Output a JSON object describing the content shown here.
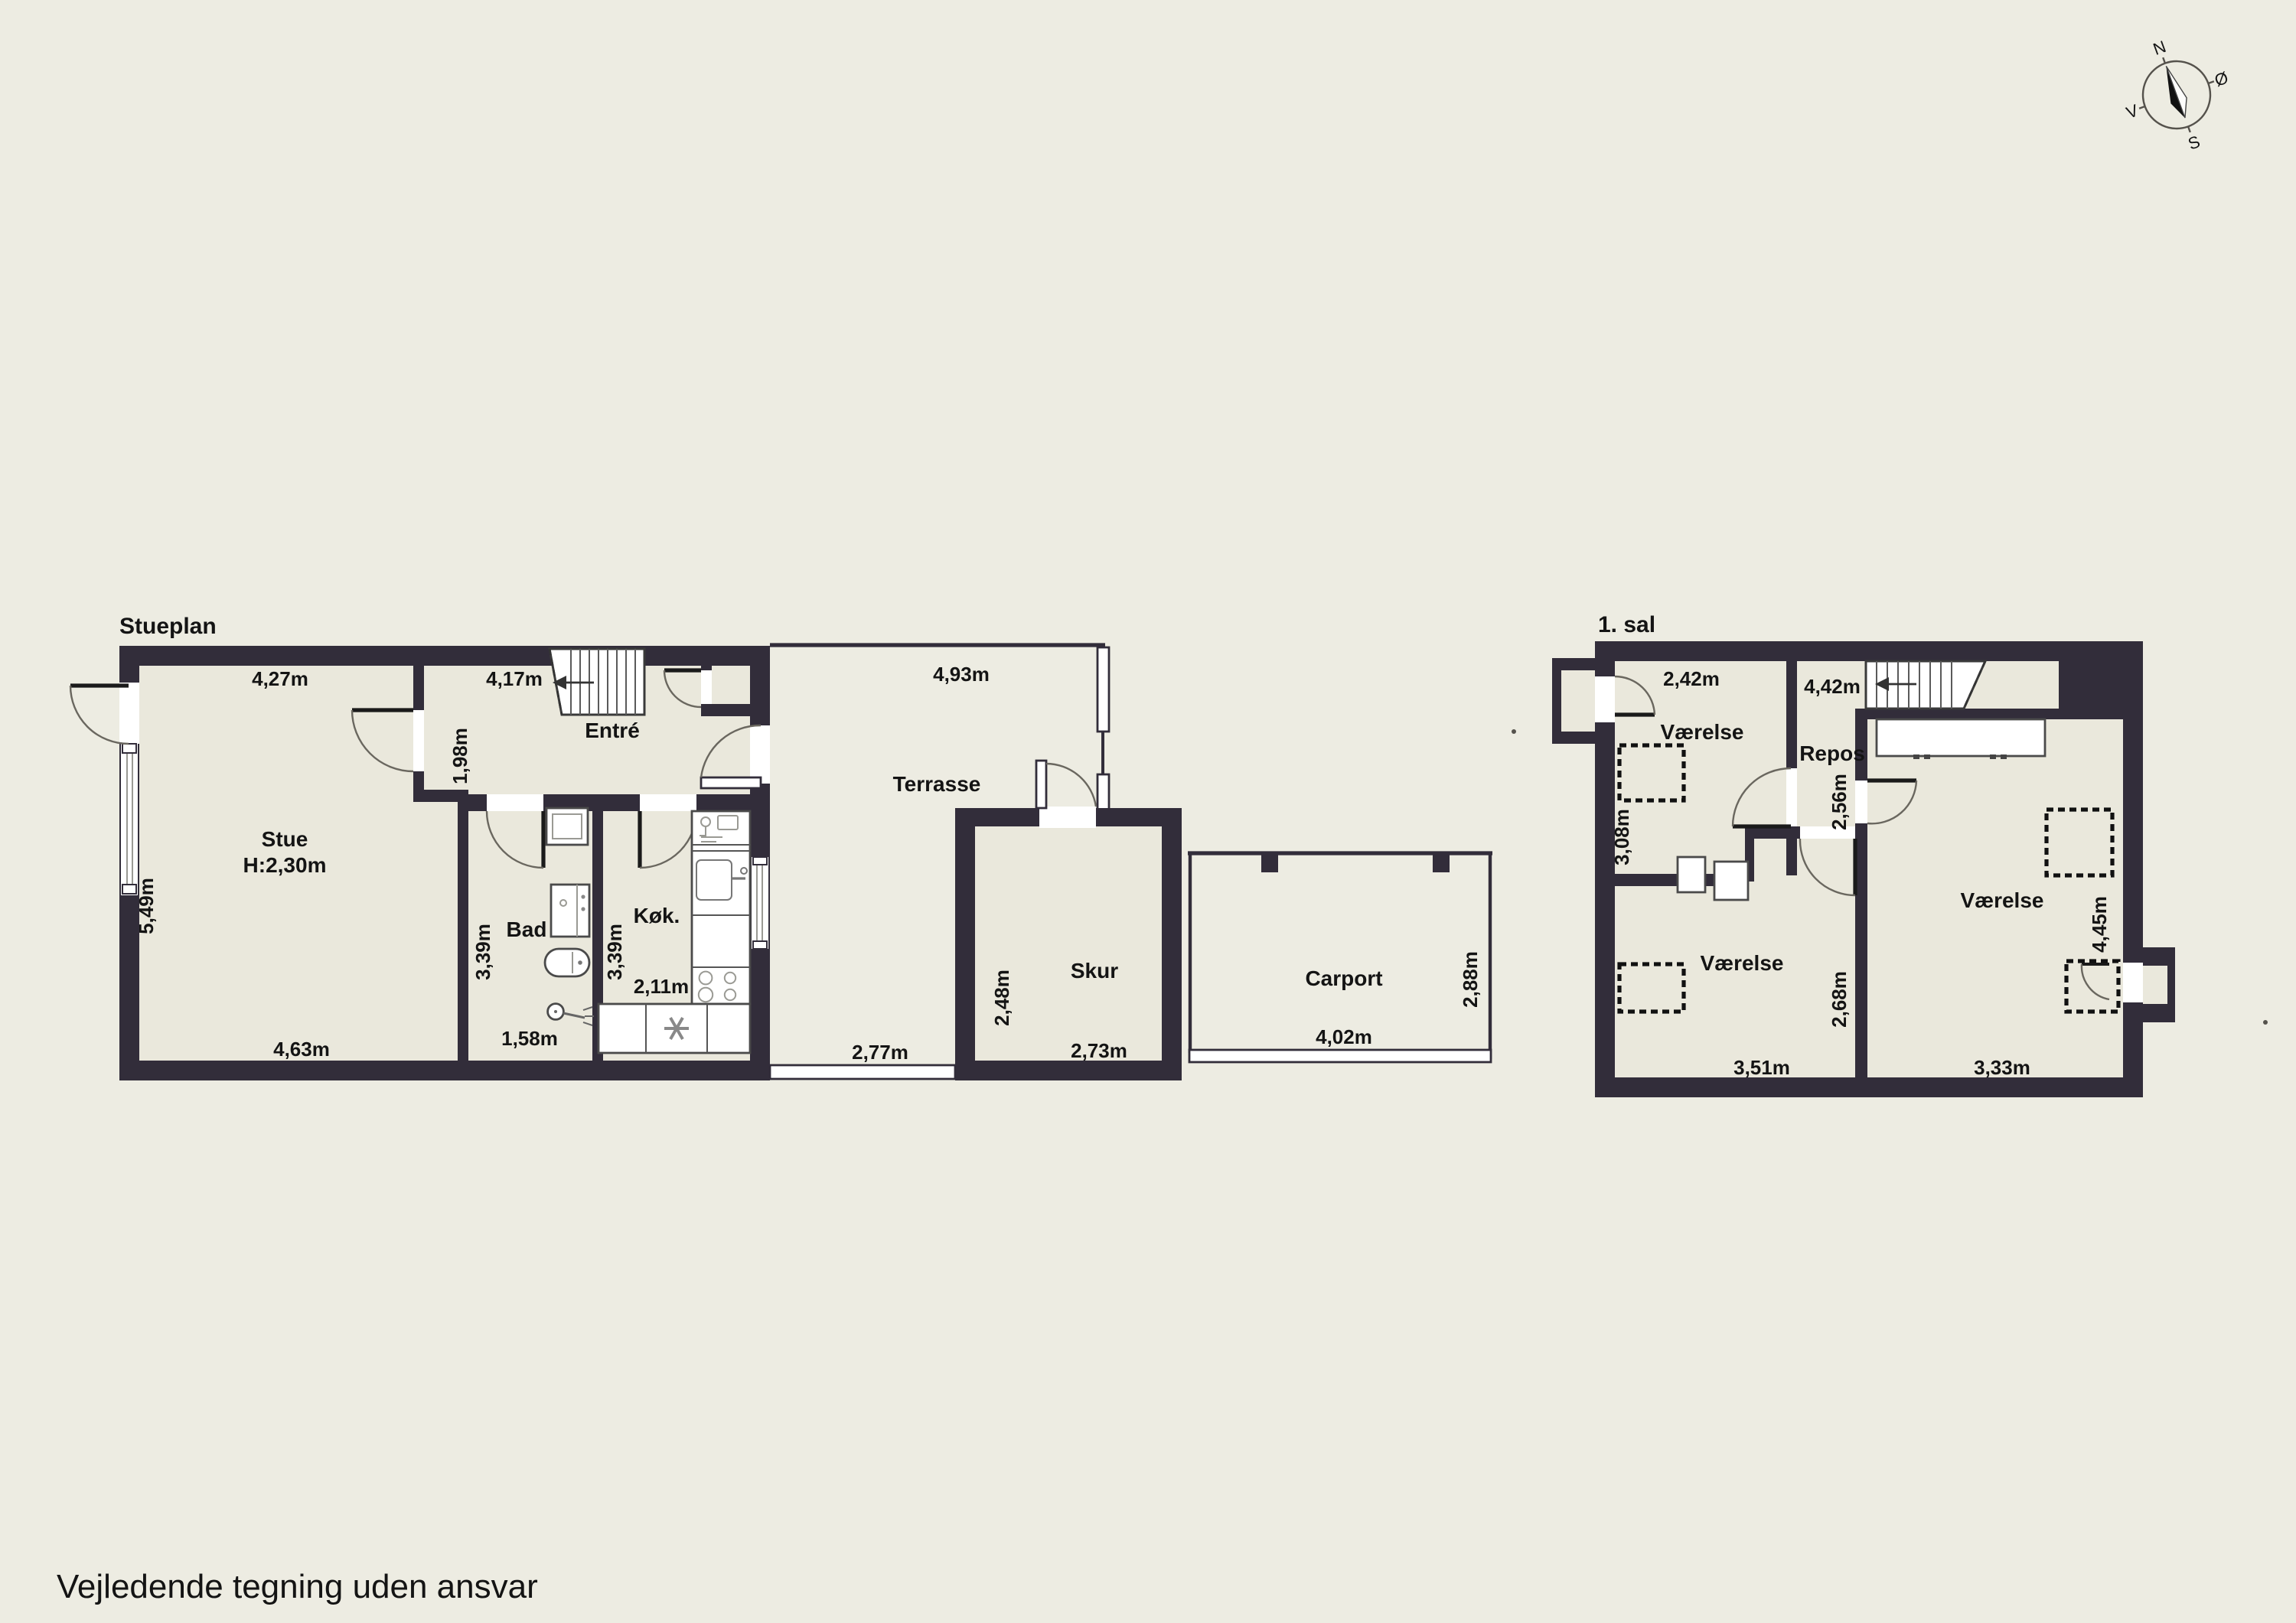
{
  "page": {
    "title_stueplan": "Stueplan",
    "title_firstfloor": "1. sal",
    "disclaimer": "Vejledende tegning uden ansvar"
  },
  "compass": {
    "north": "N",
    "east": "Ø",
    "south": "S",
    "west": "V"
  },
  "stueplan": {
    "stue": {
      "name": "Stue",
      "ceiling": "H:2,30m",
      "w_top": "4,27m",
      "h_left": "5,49m",
      "w_bottom": "4,63m"
    },
    "entre": {
      "name": "Entré",
      "w_top": "4,17m",
      "passage": "1,98m"
    },
    "bad": {
      "name": "Bad",
      "h": "3,39m",
      "w": "1,58m"
    },
    "kok": {
      "name": "Køk.",
      "h": "3,39m",
      "w": "2,11m"
    },
    "terrasse": {
      "name": "Terrasse",
      "w_top": "4,93m",
      "w_bottom": "2,77m"
    },
    "skur": {
      "name": "Skur",
      "h": "2,48m",
      "w": "2,73m"
    },
    "carport": {
      "name": "Carport",
      "h": "2,88m",
      "w": "4,02m"
    }
  },
  "firstfloor": {
    "vaerelse1": {
      "name": "Værelse",
      "w_top": "2,42m",
      "h_left": "3,08m"
    },
    "repos": {
      "name": "Repos",
      "w_top": "4,42m",
      "h": "2,56m"
    },
    "vaerelse2": {
      "name": "Værelse",
      "w": "3,51m",
      "h": "2,68m"
    },
    "vaerelse3": {
      "name": "Værelse",
      "w": "3,33m",
      "h": "4,45m"
    }
  }
}
